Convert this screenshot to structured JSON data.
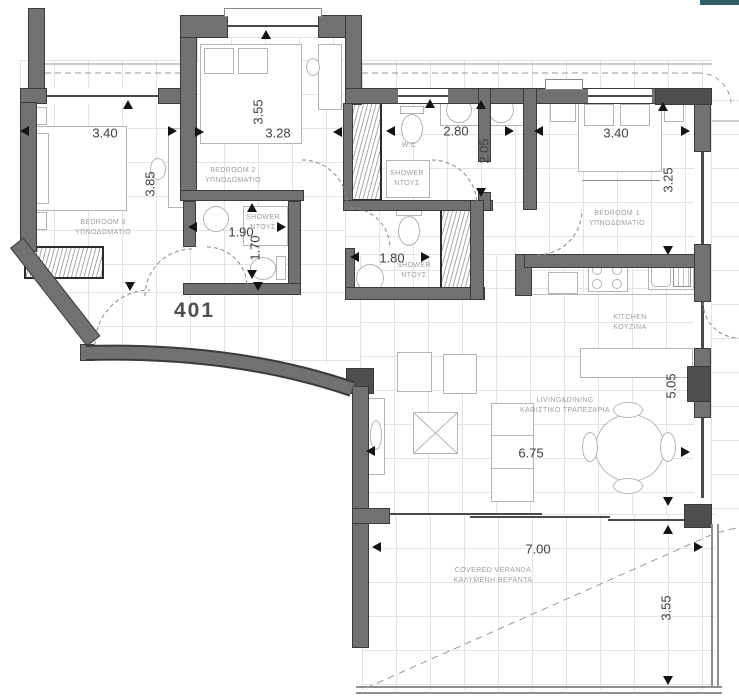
{
  "unit_number": "401",
  "rooms": {
    "bedroom3": {
      "name": "BEDROOM 3",
      "name_alt": "ΥΠΝΟΔΩΜΑΤΙΟ",
      "width": "3.40",
      "height": "3.85"
    },
    "bedroom2": {
      "name": "BEDROOM 2",
      "name_alt": "ΥΠΝΟΔΩΜΑΤΙΟ",
      "width": "3.28",
      "height": "3.55"
    },
    "shower_hall": {
      "name": "SHOWER",
      "name_alt": "ΝΤΟΥΣ",
      "width": "1.90",
      "height": "1.70"
    },
    "wc": {
      "name": "W.C",
      "width": "2.80",
      "height": "2.05"
    },
    "wc_shower": {
      "name": "SHOWER",
      "name_alt": "ΝΤΟΥΣ"
    },
    "bedroom1": {
      "name": "BEDROOM 1",
      "name_alt": "ΥΠΝΟΔΩΜΑΤΙΟ",
      "width": "3.40",
      "height": "3.25"
    },
    "ensuite_shower": {
      "name": "SHOWER",
      "name_alt": "ΝΤΟΥΣ",
      "width": "1.80"
    },
    "kitchen": {
      "name": "KITCHEN",
      "name_alt": "ΚΟΥΖΙΝΑ"
    },
    "living": {
      "name": "LIVING&DINING",
      "name_alt": "ΚΑΘΙΣΤΙΚΟ ΤΡΑΠΕΖΑΡΙΑ",
      "width": "6.75",
      "height": "5.05"
    },
    "veranda": {
      "name": "COVERED VERANDA",
      "name_alt": "ΚΑΛΥΜΕΝΗ ΒΕΡΑΝΤΑ",
      "width": "7.00",
      "height": "3.55"
    }
  },
  "colors": {
    "wall": "#717171",
    "wall_dark": "#4e4e4e",
    "wall_edge": "#3b3b3b",
    "grid": "#e3e3e3",
    "dim_text": "#3e3e3e",
    "room_label": "#9e9e9e",
    "furniture_line": "#b5b5b5",
    "accent_bar": "#2f5f66"
  }
}
